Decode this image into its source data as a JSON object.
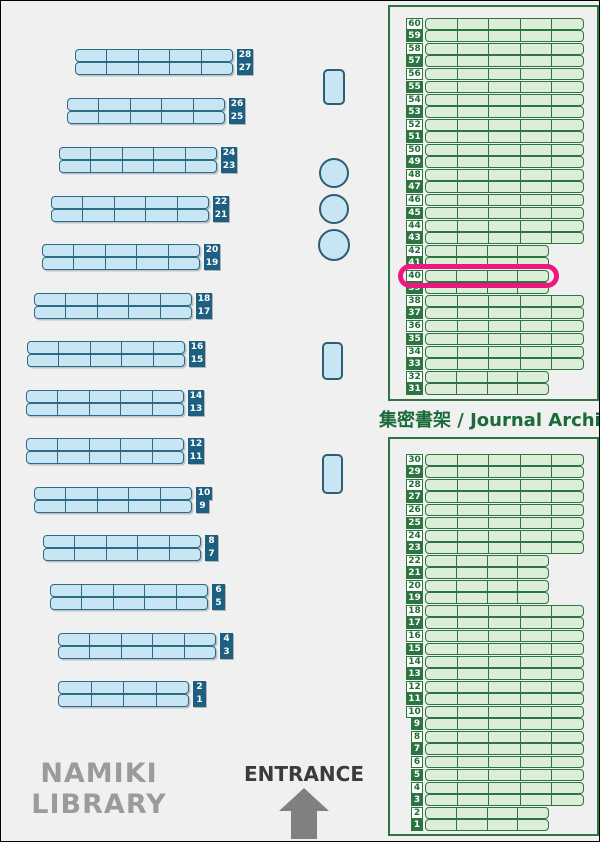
{
  "colors": {
    "background": "#f0f0f0",
    "outer_border": "#000000",
    "blue_shelf_fill": "#c8e5f4",
    "blue_shelf_border": "#2d6a84",
    "blue_label_bg": "#1d5f80",
    "blue_label_text": "#ffffff",
    "fixture_border": "#2e5d74",
    "green_border": "#2c7440",
    "green_shelf_fill": "#dcedd8",
    "green_text": "#1b6b3a",
    "green_label_light_bg": "#fdfdfa",
    "green_label_light_text": "#1f6b3c",
    "green_label_dark_bg": "#2c7440",
    "green_label_dark_text": "#ffffff",
    "highlight_pink": "#ee1780",
    "title_gray": "#9b9b9b",
    "entrance_text": "#3b3b3b",
    "arrow_gray": "#808080"
  },
  "title": {
    "line1": "NAMIKI",
    "line2": "LIBRARY"
  },
  "entrance": {
    "label": "ENTRANCE"
  },
  "main_shelves": {
    "pairs": [
      {
        "top": 28,
        "bottom": 27,
        "x": 74,
        "y": 48,
        "width": 158,
        "segments": 5
      },
      {
        "top": 26,
        "bottom": 25,
        "x": 66,
        "y": 97,
        "width": 158,
        "segments": 5
      },
      {
        "top": 24,
        "bottom": 23,
        "x": 58,
        "y": 146,
        "width": 158,
        "segments": 5
      },
      {
        "top": 22,
        "bottom": 21,
        "x": 50,
        "y": 195,
        "width": 158,
        "segments": 5
      },
      {
        "top": 20,
        "bottom": 19,
        "x": 41,
        "y": 243,
        "width": 158,
        "segments": 5
      },
      {
        "top": 18,
        "bottom": 17,
        "x": 33,
        "y": 292,
        "width": 158,
        "segments": 5
      },
      {
        "top": 16,
        "bottom": 15,
        "x": 26,
        "y": 340,
        "width": 158,
        "segments": 5
      },
      {
        "top": 14,
        "bottom": 13,
        "x": 25,
        "y": 389,
        "width": 158,
        "segments": 5
      },
      {
        "top": 12,
        "bottom": 11,
        "x": 25,
        "y": 437,
        "width": 158,
        "segments": 5
      },
      {
        "top": 10,
        "bottom": 9,
        "x": 33,
        "y": 486,
        "width": 158,
        "segments": 5
      },
      {
        "top": 8,
        "bottom": 7,
        "x": 42,
        "y": 534,
        "width": 158,
        "segments": 5
      },
      {
        "top": 6,
        "bottom": 5,
        "x": 49,
        "y": 583,
        "width": 158,
        "segments": 5
      },
      {
        "top": 4,
        "bottom": 3,
        "x": 57,
        "y": 632,
        "width": 158,
        "segments": 5
      },
      {
        "top": 2,
        "bottom": 1,
        "x": 57,
        "y": 680,
        "width": 131,
        "segments": 4
      }
    ]
  },
  "fixtures": {
    "pillars": [
      {
        "x": 322,
        "y": 68,
        "w": 22,
        "h": 36
      },
      {
        "x": 321,
        "y": 341,
        "w": 21,
        "h": 38
      },
      {
        "x": 321,
        "y": 453,
        "w": 21,
        "h": 40
      }
    ],
    "tables": [
      {
        "cx": 333,
        "cy": 172,
        "r": 15
      },
      {
        "cx": 333,
        "cy": 208,
        "r": 15
      },
      {
        "cx": 333,
        "cy": 244,
        "r": 16
      }
    ]
  },
  "archive": {
    "label": "集密書架 / Journal Archive",
    "shelf_x": 424,
    "label_right": 422,
    "full_shelf_width": 159,
    "short_shelf_width": 124,
    "row_pitch": 12.2,
    "pair_pitch": 25.2,
    "short_rows": [
      42,
      41,
      40,
      39,
      32,
      31,
      22,
      21,
      20,
      19,
      2,
      1
    ],
    "dark_label_parity": "odd",
    "top_box": {
      "x": 387,
      "y": 4,
      "w": 211,
      "h": 396,
      "rows_start_y": 17,
      "rows": [
        60,
        59,
        58,
        57,
        56,
        55,
        54,
        53,
        52,
        51,
        50,
        49,
        48,
        47,
        46,
        45,
        44,
        43,
        42,
        41,
        40,
        39,
        38,
        37,
        36,
        35,
        34,
        33,
        32,
        31
      ]
    },
    "bottom_box": {
      "x": 387,
      "y": 436,
      "w": 211,
      "h": 399,
      "rows_start_y": 453,
      "rows": [
        30,
        29,
        28,
        27,
        26,
        25,
        24,
        23,
        22,
        21,
        20,
        19,
        18,
        17,
        16,
        15,
        14,
        13,
        12,
        11,
        10,
        9,
        8,
        7,
        6,
        5,
        4,
        3,
        2,
        1
      ]
    },
    "highlight": {
      "row": 40
    }
  }
}
